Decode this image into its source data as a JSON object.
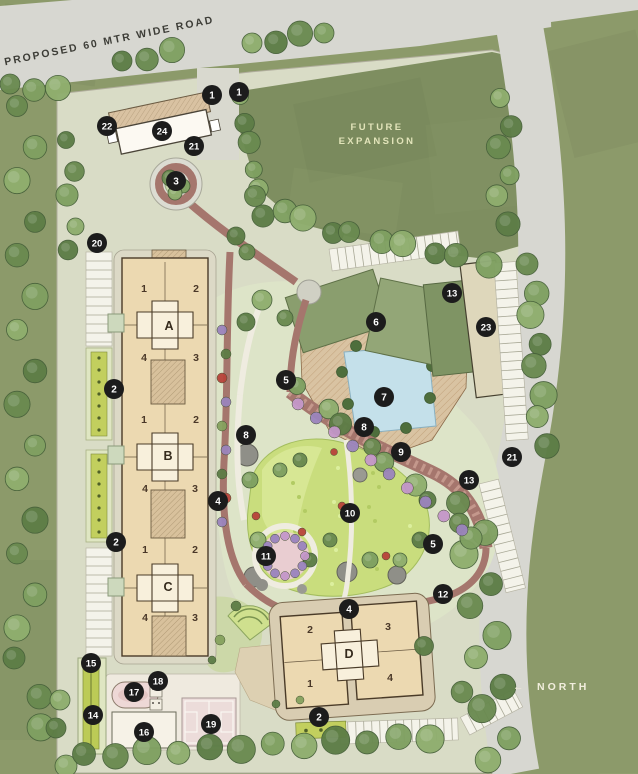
{
  "plan": {
    "title": "Residential Master Site Plan",
    "road_label": "PROPOSED 60 MTR WIDE ROAD",
    "future_expansion": {
      "line1": "FUTURE",
      "line2": "EXPANSION"
    },
    "north": {
      "arrow": "←",
      "label": "NORTH"
    },
    "buildings": [
      {
        "letter": "A",
        "x": 169,
        "y": 330,
        "units": [
          {
            "no": "1",
            "x": 144,
            "y": 292
          },
          {
            "no": "2",
            "x": 196,
            "y": 292
          },
          {
            "no": "4",
            "x": 144,
            "y": 361
          },
          {
            "no": "3",
            "x": 196,
            "y": 361
          }
        ]
      },
      {
        "letter": "B",
        "x": 168,
        "y": 460,
        "units": [
          {
            "no": "1",
            "x": 144,
            "y": 423
          },
          {
            "no": "2",
            "x": 196,
            "y": 423
          },
          {
            "no": "4",
            "x": 145,
            "y": 492
          },
          {
            "no": "3",
            "x": 195,
            "y": 492
          }
        ]
      },
      {
        "letter": "C",
        "x": 168,
        "y": 591,
        "units": [
          {
            "no": "1",
            "x": 145,
            "y": 553
          },
          {
            "no": "2",
            "x": 195,
            "y": 553
          },
          {
            "no": "4",
            "x": 145,
            "y": 621
          },
          {
            "no": "3",
            "x": 195,
            "y": 621
          }
        ]
      },
      {
        "letter": "D",
        "x": 349,
        "y": 658,
        "units": [
          {
            "no": "2",
            "x": 310,
            "y": 633
          },
          {
            "no": "3",
            "x": 388,
            "y": 630
          },
          {
            "no": "1",
            "x": 310,
            "y": 687
          },
          {
            "no": "4",
            "x": 390,
            "y": 681
          }
        ]
      }
    ],
    "markers": [
      {
        "no": "1",
        "x": 212,
        "y": 95
      },
      {
        "no": "1",
        "x": 239,
        "y": 92
      },
      {
        "no": "2",
        "x": 114,
        "y": 389
      },
      {
        "no": "2",
        "x": 116,
        "y": 542
      },
      {
        "no": "2",
        "x": 319,
        "y": 717
      },
      {
        "no": "3",
        "x": 176,
        "y": 181
      },
      {
        "no": "4",
        "x": 218,
        "y": 501
      },
      {
        "no": "4",
        "x": 349,
        "y": 609
      },
      {
        "no": "5",
        "x": 286,
        "y": 380
      },
      {
        "no": "5",
        "x": 433,
        "y": 544
      },
      {
        "no": "6",
        "x": 376,
        "y": 322
      },
      {
        "no": "7",
        "x": 384,
        "y": 397
      },
      {
        "no": "8",
        "x": 246,
        "y": 435
      },
      {
        "no": "8",
        "x": 364,
        "y": 427
      },
      {
        "no": "9",
        "x": 401,
        "y": 452
      },
      {
        "no": "10",
        "x": 350,
        "y": 513
      },
      {
        "no": "11",
        "x": 266,
        "y": 556
      },
      {
        "no": "12",
        "x": 443,
        "y": 594
      },
      {
        "no": "13",
        "x": 452,
        "y": 293
      },
      {
        "no": "13",
        "x": 469,
        "y": 480
      },
      {
        "no": "14",
        "x": 93,
        "y": 715
      },
      {
        "no": "15",
        "x": 91,
        "y": 663
      },
      {
        "no": "16",
        "x": 144,
        "y": 732
      },
      {
        "no": "17",
        "x": 134,
        "y": 692
      },
      {
        "no": "18",
        "x": 158,
        "y": 681
      },
      {
        "no": "19",
        "x": 211,
        "y": 724
      },
      {
        "no": "20",
        "x": 97,
        "y": 243
      },
      {
        "no": "21",
        "x": 194,
        "y": 146
      },
      {
        "no": "21",
        "x": 512,
        "y": 457
      },
      {
        "no": "22",
        "x": 107,
        "y": 126
      },
      {
        "no": "23",
        "x": 486,
        "y": 327
      },
      {
        "no": "24",
        "x": 162,
        "y": 131
      }
    ],
    "colors": {
      "field_green": "#8c9a6a",
      "future_expansion_green": "#7e8e60",
      "site_base": "#d9dcc6",
      "road_gray": "#d7d7d1",
      "building_fill": "#ecd9b1",
      "building_stroke": "#4a3b28",
      "core_fill": "#f8f0dc",
      "pool_blue": "#c4e0ea",
      "deck_tan": "#d9c3a2",
      "lawn_green": "#c9dd7d",
      "brick_path": "#a5766d",
      "marker_bg": "#1c1c1c",
      "marker_text": "#ffffff",
      "unit_text": "#4a3828",
      "letter_text": "#352a1c"
    }
  }
}
